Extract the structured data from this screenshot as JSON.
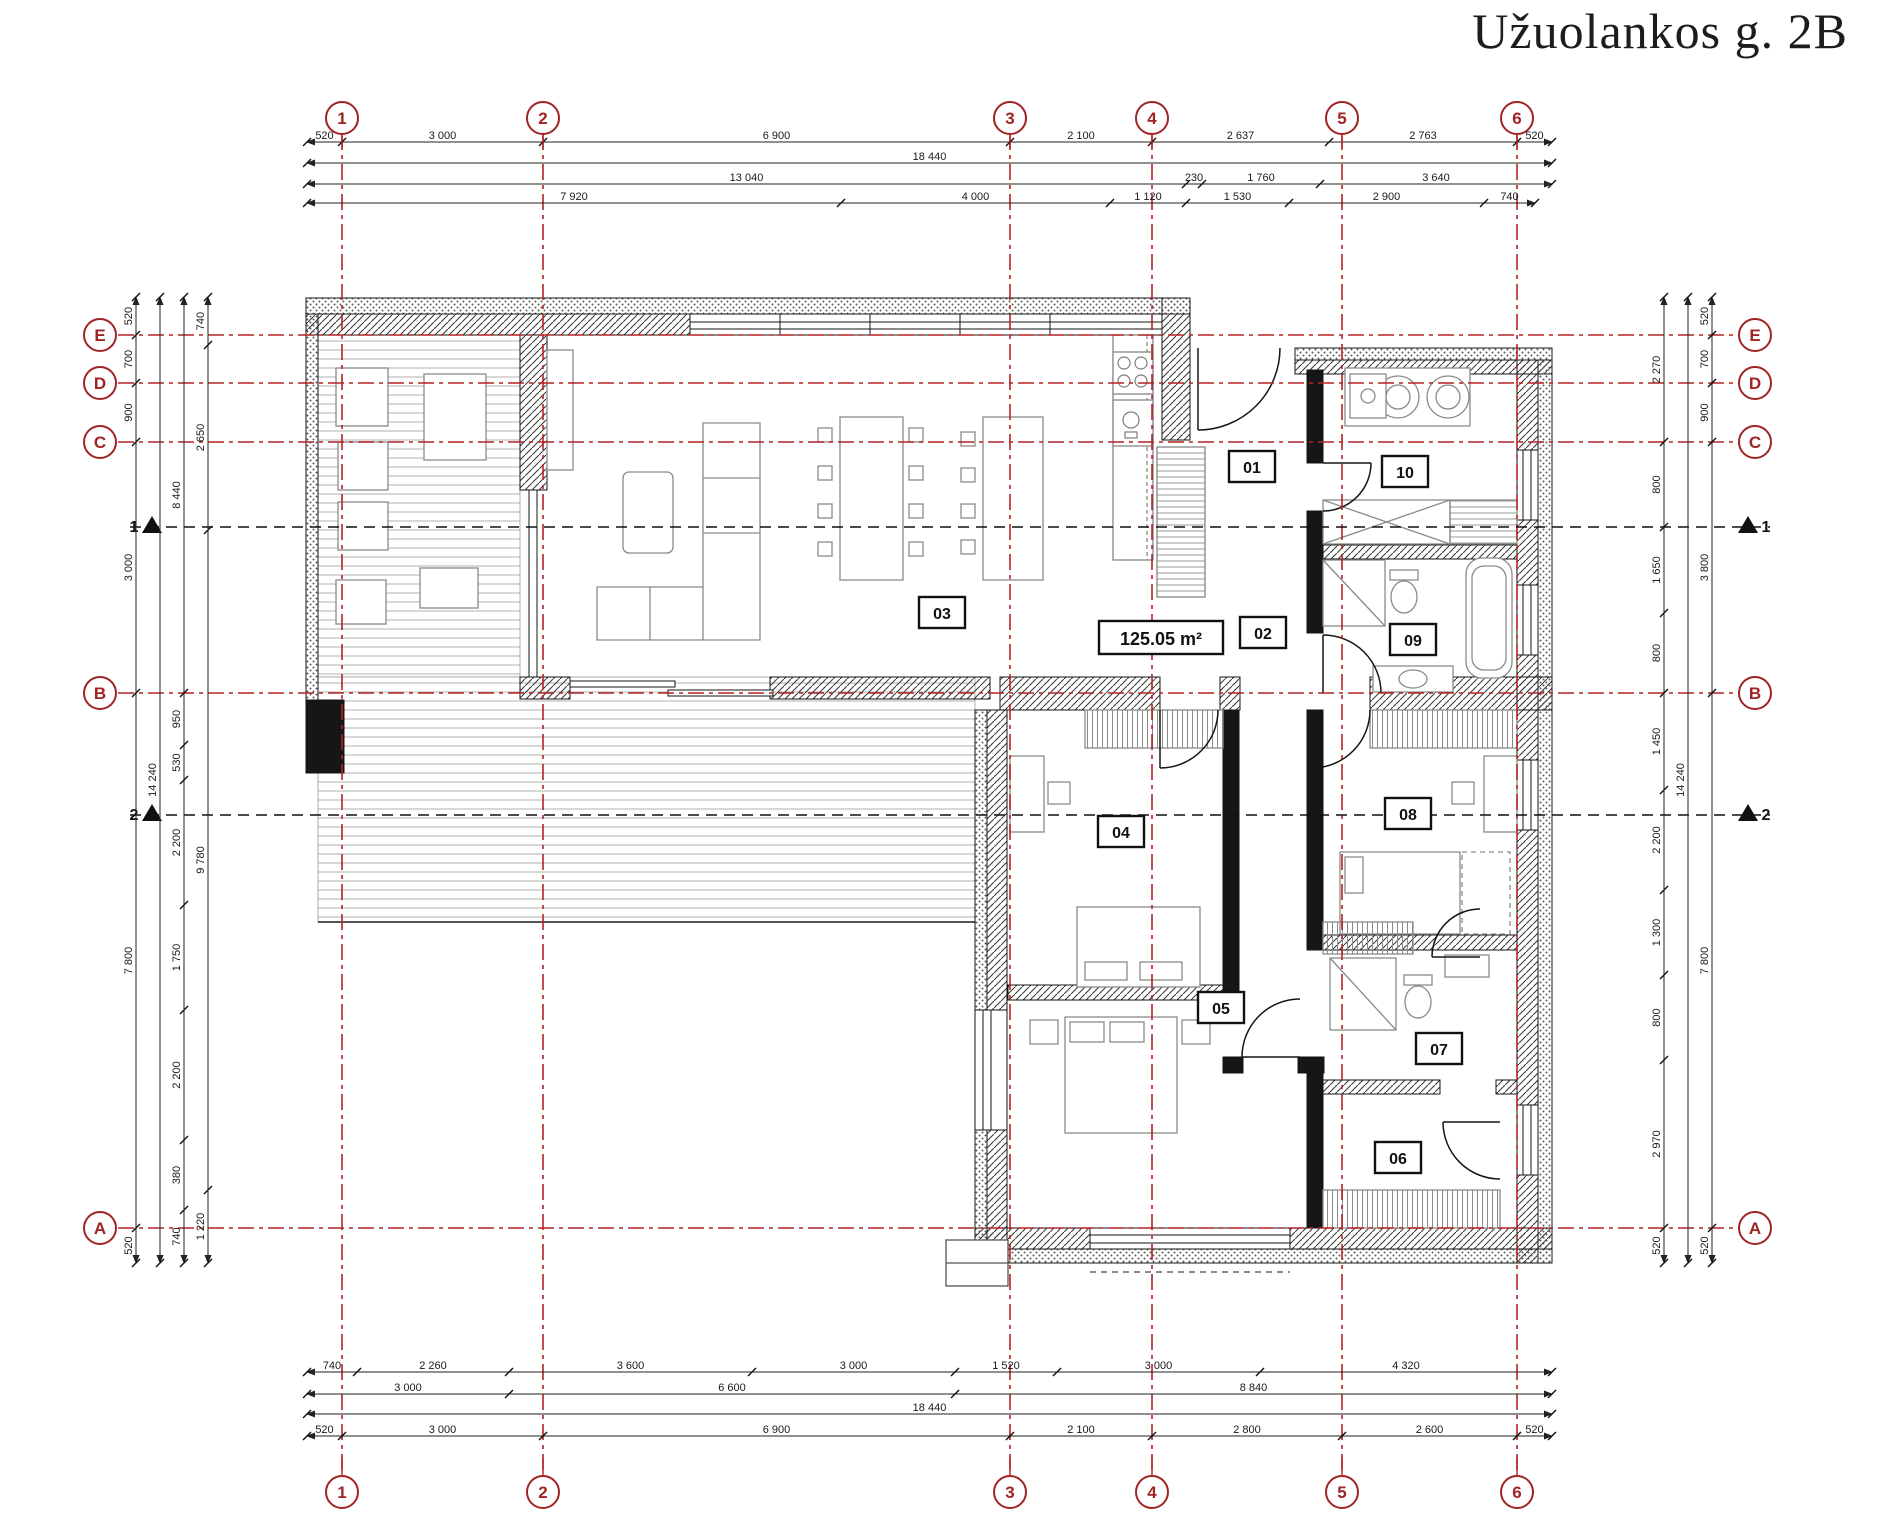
{
  "title": "Užuolankos g. 2B",
  "area_label": "125.05 m²",
  "colors": {
    "grid_red": "#b42222",
    "bubble_red": "#a02424",
    "wall": "#141414",
    "furniture": "#8a8a8a",
    "dim_text": "#1a1a1a"
  },
  "grid": {
    "columns": [
      {
        "label": "1",
        "x": 342
      },
      {
        "label": "2",
        "x": 543
      },
      {
        "label": "3",
        "x": 1010
      },
      {
        "label": "4",
        "x": 1152
      },
      {
        "label": "5",
        "x": 1342
      },
      {
        "label": "6",
        "x": 1517
      }
    ],
    "rows": [
      {
        "label": "E",
        "y": 335
      },
      {
        "label": "D",
        "y": 383
      },
      {
        "label": "C",
        "y": 442
      },
      {
        "label": "B",
        "y": 693
      },
      {
        "label": "A",
        "y": 1228
      }
    ],
    "bubble_top_y": 118,
    "bubble_bottom_y": 1492,
    "bubble_left_x": 100,
    "bubble_right_x": 1755,
    "vline_y1": 134,
    "vline_y2": 1474,
    "hline_x1": 118,
    "hline_x2": 1739
  },
  "sections": [
    {
      "label": "1",
      "y": 527
    },
    {
      "label": "2",
      "y": 815
    }
  ],
  "dim_chains": {
    "horizontal": [
      {
        "y": 142,
        "x1": 307,
        "segments": [
          {
            "v": "520",
            "to": 342
          },
          {
            "v": "3 000",
            "to": 543
          },
          {
            "v": "6 900",
            "to": 1010
          },
          {
            "v": "2 100",
            "to": 1152
          },
          {
            "v": "2 637",
            "to": 1329
          },
          {
            "v": "2 763",
            "to": 1517
          },
          {
            "v": "520",
            "to": 1552
          }
        ]
      },
      {
        "y": 163,
        "x1": 307,
        "segments": [
          {
            "v": "18 440",
            "to": 1552
          }
        ]
      },
      {
        "y": 184,
        "x1": 307,
        "segments": [
          {
            "v": "13 040",
            "to": 1186
          },
          {
            "v": "230",
            "to": 1202
          },
          {
            "v": "1 760",
            "to": 1320
          },
          {
            "v": "3 640",
            "to": 1552
          }
        ]
      },
      {
        "y": 203,
        "x1": 307,
        "segments": [
          {
            "v": "7 920",
            "to": 841
          },
          {
            "v": "4 000",
            "to": 1110
          },
          {
            "v": "1 120",
            "to": 1186
          },
          {
            "v": "1 530",
            "to": 1289
          },
          {
            "v": "2 900",
            "to": 1484
          },
          {
            "v": "740",
            "to": 1535
          }
        ]
      },
      {
        "y": 1372,
        "x1": 307,
        "segments": [
          {
            "v": "740",
            "to": 357
          },
          {
            "v": "2 260",
            "to": 509
          },
          {
            "v": "3 600",
            "to": 752
          },
          {
            "v": "3 000",
            "to": 955
          },
          {
            "v": "1 520",
            "to": 1057
          },
          {
            "v": "3 000",
            "to": 1260
          },
          {
            "v": "4 320",
            "to": 1552
          }
        ]
      },
      {
        "y": 1394,
        "x1": 307,
        "segments": [
          {
            "v": "3 000",
            "to": 509
          },
          {
            "v": "6 600",
            "to": 955
          },
          {
            "v": "8 840",
            "to": 1552
          }
        ]
      },
      {
        "y": 1414,
        "x1": 307,
        "segments": [
          {
            "v": "18 440",
            "to": 1552
          }
        ]
      },
      {
        "y": 1436,
        "x1": 307,
        "segments": [
          {
            "v": "520",
            "to": 342
          },
          {
            "v": "3 000",
            "to": 543
          },
          {
            "v": "6 900",
            "to": 1010
          },
          {
            "v": "2 100",
            "to": 1152
          },
          {
            "v": "2 800",
            "to": 1342
          },
          {
            "v": "2 600",
            "to": 1517
          },
          {
            "v": "520",
            "to": 1552
          }
        ]
      }
    ],
    "vertical": [
      {
        "x": 136,
        "y1": 297,
        "segments": [
          {
            "v": "520",
            "to": 335
          },
          {
            "v": "700",
            "to": 383
          },
          {
            "v": "900",
            "to": 442
          },
          {
            "v": "3 000",
            "to": 693
          },
          {
            "v": "7 800",
            "to": 1228
          },
          {
            "v": "520",
            "to": 1263
          }
        ]
      },
      {
        "x": 160,
        "y1": 297,
        "segments": [
          {
            "v": "14 240",
            "to": 1263
          }
        ]
      },
      {
        "x": 184,
        "y1": 297,
        "segments": [
          {
            "v": "8 440",
            "to": 693
          },
          {
            "v": "950",
            "to": 745
          },
          {
            "v": "530",
            "to": 780
          },
          {
            "v": "2 200",
            "to": 905
          },
          {
            "v": "1 750",
            "to": 1010
          },
          {
            "v": "2 200",
            "to": 1140
          },
          {
            "v": "380",
            "to": 1210
          },
          {
            "v": "740",
            "to": 1263
          }
        ]
      },
      {
        "x": 208,
        "y1": 297,
        "segments": [
          {
            "v": "740",
            "to": 345
          },
          {
            "v": "2 650",
            "to": 530
          },
          {
            "v": "9 780",
            "to": 1190
          },
          {
            "v": "1 220",
            "to": 1263
          }
        ]
      },
      {
        "x": 1664,
        "y1": 297,
        "segments": [
          {
            "v": "2 270",
            "to": 442
          },
          {
            "v": "800",
            "to": 527
          },
          {
            "v": "1 650",
            "to": 613
          },
          {
            "v": "800",
            "to": 693
          },
          {
            "v": "1 450",
            "to": 790
          },
          {
            "v": "2 200",
            "to": 890
          },
          {
            "v": "1 300",
            "to": 975
          },
          {
            "v": "800",
            "to": 1060
          },
          {
            "v": "2 970",
            "to": 1228
          },
          {
            "v": "520",
            "to": 1263
          }
        ]
      },
      {
        "x": 1688,
        "y1": 297,
        "segments": [
          {
            "v": "14 240",
            "to": 1263
          }
        ]
      },
      {
        "x": 1712,
        "y1": 297,
        "segments": [
          {
            "v": "520",
            "to": 335
          },
          {
            "v": "700",
            "to": 383
          },
          {
            "v": "900",
            "to": 442
          },
          {
            "v": "3 800",
            "to": 693
          },
          {
            "v": "7 800",
            "to": 1228
          },
          {
            "v": "520",
            "to": 1263
          }
        ]
      }
    ]
  },
  "rooms": [
    {
      "number": "01",
      "cx": 1252,
      "cy": 467
    },
    {
      "number": "02",
      "cx": 1263,
      "cy": 633
    },
    {
      "number": "03",
      "cx": 942,
      "cy": 613
    },
    {
      "number": "04",
      "cx": 1121,
      "cy": 832
    },
    {
      "number": "05",
      "cx": 1221,
      "cy": 1008
    },
    {
      "number": "06",
      "cx": 1398,
      "cy": 1158
    },
    {
      "number": "07",
      "cx": 1439,
      "cy": 1049
    },
    {
      "number": "08",
      "cx": 1408,
      "cy": 814
    },
    {
      "number": "09",
      "cx": 1413,
      "cy": 640
    },
    {
      "number": "10",
      "cx": 1405,
      "cy": 472
    }
  ],
  "area_box": {
    "cx": 1161,
    "cy": 638
  }
}
